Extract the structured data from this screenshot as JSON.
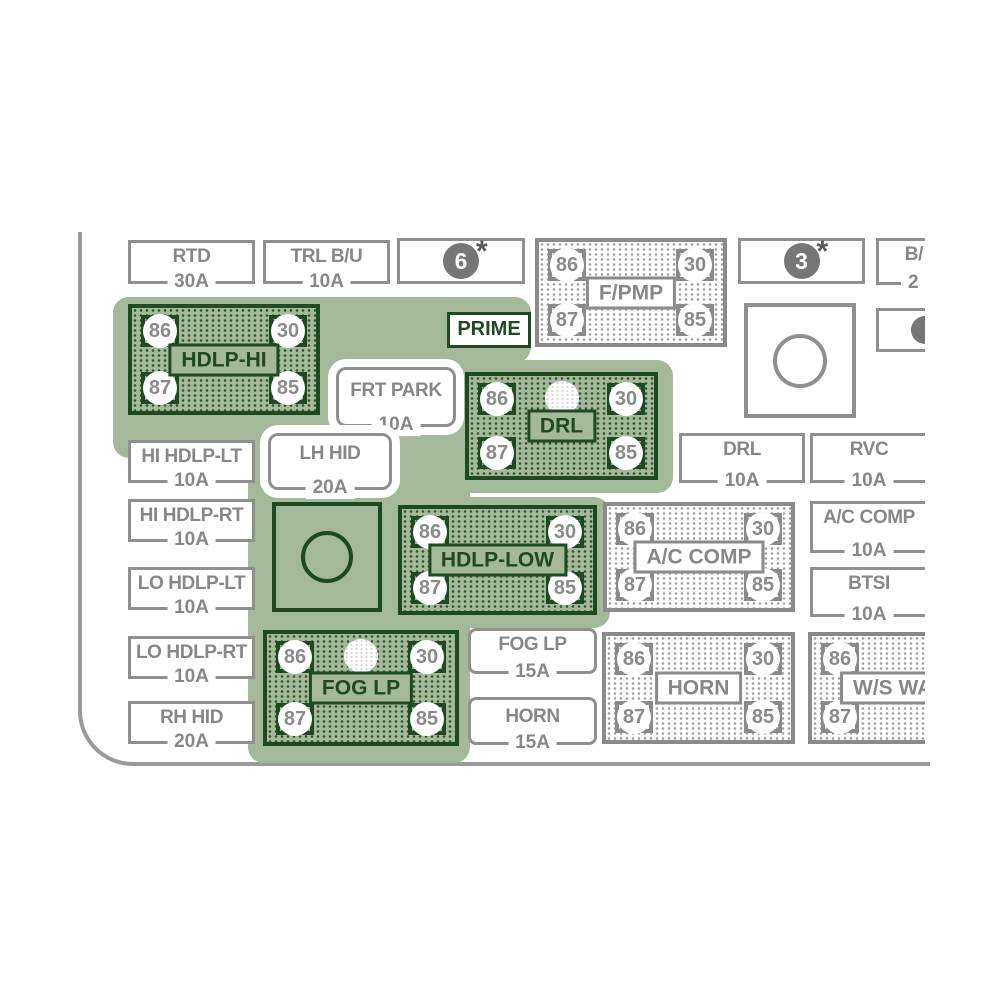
{
  "colors": {
    "highlight_green": "#A3B999",
    "dark_green": "#1F4A21",
    "label_grey": "#878787"
  },
  "pins": {
    "tl": "86",
    "tr": "30",
    "bl": "87",
    "br": "85"
  },
  "badges": {
    "six": "6",
    "three": "3",
    "star": "*"
  },
  "prime_label": "PRIME",
  "fuses": {
    "rtd": {
      "label": "RTD",
      "amp": "30A"
    },
    "trl_bu": {
      "label": "TRL B/U",
      "amp": "10A"
    },
    "hi_hdlp_lt": {
      "label": "HI HDLP-LT",
      "amp": "10A"
    },
    "hi_hdlp_rt": {
      "label": "HI HDLP-RT",
      "amp": "10A"
    },
    "lo_hdlp_lt": {
      "label": "LO HDLP-LT",
      "amp": "10A"
    },
    "lo_hdlp_rt": {
      "label": "LO HDLP-RT",
      "amp": "10A"
    },
    "rh_hid": {
      "label": "RH HID",
      "amp": "20A"
    },
    "frt_park": {
      "label": "FRT PARK",
      "amp": "10A"
    },
    "lh_hid": {
      "label": "LH HID",
      "amp": "20A"
    },
    "drl": {
      "label": "DRL",
      "amp": "10A"
    },
    "rvc": {
      "label": "RVC",
      "amp": "10A"
    },
    "ac_comp": {
      "label": "A/C COMP",
      "amp": "10A"
    },
    "btsi": {
      "label": "BTSI",
      "amp": "10A"
    },
    "fog_lp": {
      "label": "FOG LP",
      "amp": "15A"
    },
    "horn": {
      "label": "HORN",
      "amp": "15A"
    },
    "bu_partial": {
      "label": "B/",
      "amp": "2"
    }
  },
  "relays": {
    "fpmp": {
      "label": "F/PMP"
    },
    "hdlp_hi": {
      "label": "HDLP-HI"
    },
    "drl": {
      "label": "DRL"
    },
    "hdlp_low": {
      "label": "HDLP-LOW"
    },
    "fog_lp": {
      "label": "FOG LP"
    },
    "ac_comp": {
      "label": "A/C COMP"
    },
    "horn": {
      "label": "HORN"
    },
    "ws_wa": {
      "label": "W/S WA"
    }
  }
}
